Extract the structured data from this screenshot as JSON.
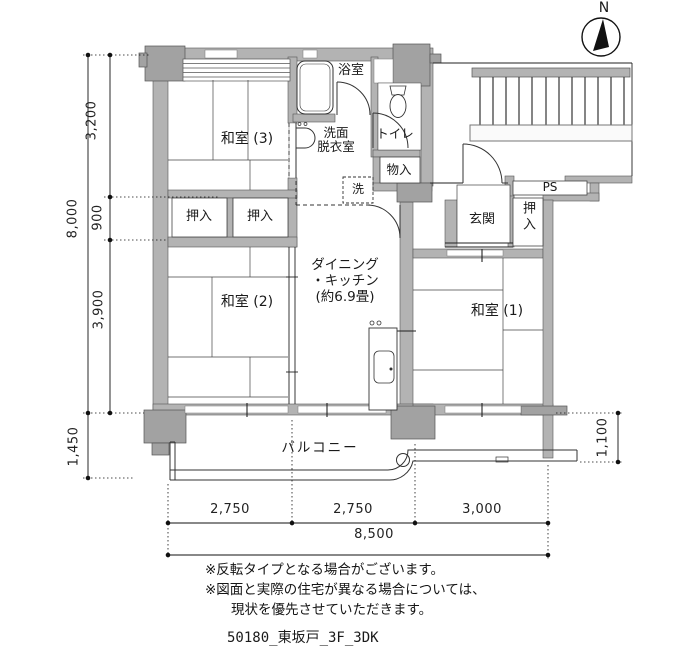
{
  "north_label": "N",
  "rooms": {
    "washitsu3": "和室 (3)",
    "washitsu2": "和室 (2)",
    "washitsu1": "和室 (1)",
    "oshiire_left": "押入",
    "oshiire_mid": "押入",
    "oshiire_right": "押入",
    "bath": "浴室",
    "washroom_l1": "洗面",
    "washroom_l2": "脱衣室",
    "toilet": "トイレ",
    "storage": "物入",
    "laundry": "洗",
    "genkan": "玄関",
    "ps": "PS",
    "dk_l1": "ダイニング",
    "dk_l2": "・キッチン",
    "dk_l3": "(約6.9畳)",
    "balcony": "バルコニー"
  },
  "dimensions": {
    "left_total": "8,000",
    "left_seg_top": "3,200",
    "left_seg_mid": "900",
    "left_seg_bottom": "3,900",
    "left_balcony_depth": "1,450",
    "right_balcony_depth": "1,100",
    "bottom_seg_left": "2,750",
    "bottom_seg_mid": "2,750",
    "bottom_seg_right": "3,000",
    "bottom_total": "8,500"
  },
  "notes": {
    "line1": "※反転タイプとなる場合がございます。",
    "line2": "※図面と実際の住宅が異なる場合については、",
    "line3": "現状を優先させていただきます。"
  },
  "footer": "50180_東坂戸_3F_3DK",
  "colors": {
    "wall_fill": "#b3b3b3",
    "column_fill": "#a2a2a2",
    "line": "#1a1a1a"
  }
}
